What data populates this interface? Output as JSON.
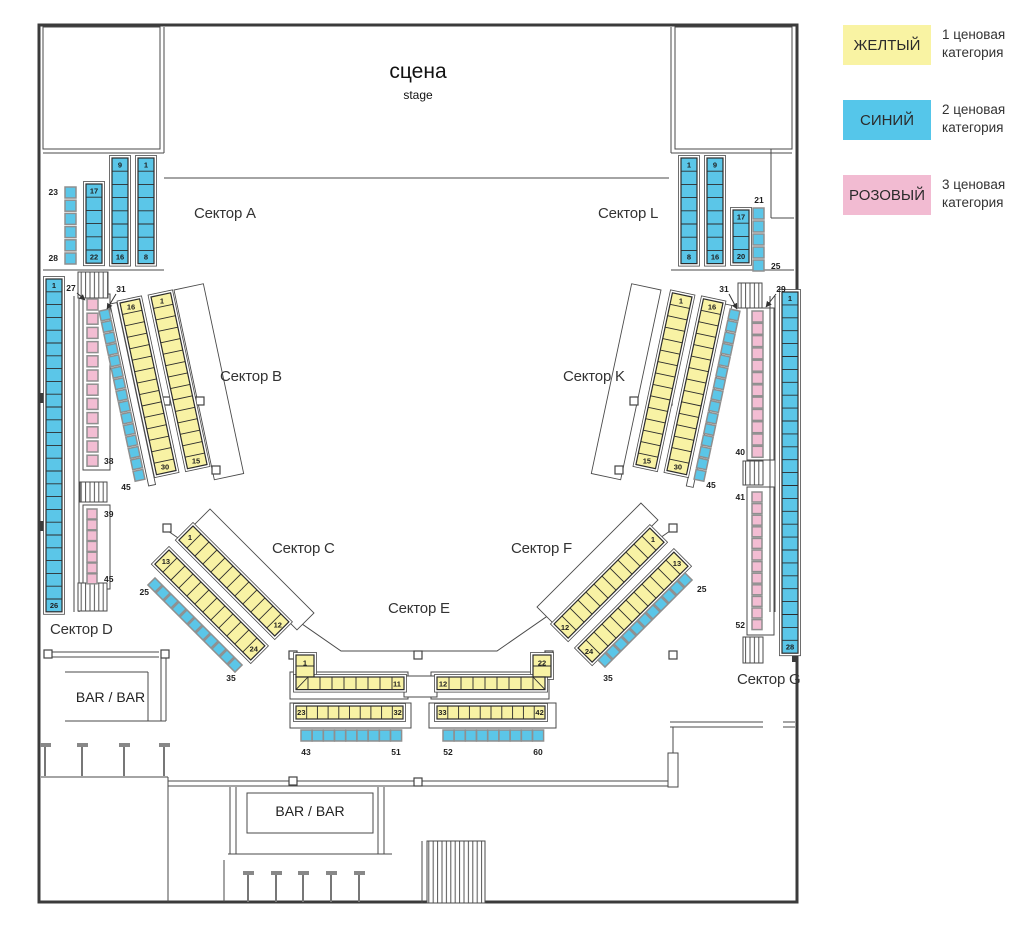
{
  "stage": {
    "title": "сцена",
    "subtitle": "stage"
  },
  "bars": {
    "left": "BAR / BAR",
    "bottom": "BAR / BAR"
  },
  "legend": [
    {
      "label": "ЖЕЛТЫЙ",
      "category": 1,
      "desc": "1 ценовая категория",
      "desc_lines": [
        "1 ценовая",
        "категория"
      ],
      "color": "#F9F3A3"
    },
    {
      "label": "СИНИЙ",
      "category": 2,
      "desc": "2 ценовая категория",
      "desc_lines": [
        "2 ценовая",
        "категория"
      ],
      "color": "#55C6EA"
    },
    {
      "label": "РОЗОВЫЙ",
      "category": 3,
      "desc": "3 ценовая категория",
      "desc_lines": [
        "3 ценовая",
        "категория"
      ],
      "color": "#F2BBD2"
    }
  ],
  "sectors": [
    {
      "id": "A",
      "label": "Сектор A"
    },
    {
      "id": "L",
      "label": "Сектор L"
    },
    {
      "id": "B",
      "label": "Сектор B"
    },
    {
      "id": "K",
      "label": "Сектор K"
    },
    {
      "id": "C",
      "label": "Сектор C"
    },
    {
      "id": "F",
      "label": "Сектор F"
    },
    {
      "id": "E",
      "label": "Сектор E"
    },
    {
      "id": "D",
      "label": "Сектор D"
    },
    {
      "id": "G",
      "label": "Сектор G"
    }
  ],
  "seat_colors": {
    "yellow": "#F8F2A4",
    "blue": "#5BC6E8",
    "pink": "#F3BDD3"
  },
  "seat_groups": [
    {
      "id": "a-strip-1-8",
      "sector": "A",
      "color": "blue",
      "category": 2,
      "first": 1,
      "last": 8,
      "count": 8,
      "label_start": "1",
      "label_end": "8"
    },
    {
      "id": "a-strip-9-16",
      "sector": "A",
      "color": "blue",
      "category": 2,
      "first": 9,
      "last": 16,
      "count": 8,
      "label_start": "9",
      "label_end": "16"
    },
    {
      "id": "a-strip-17-22",
      "sector": "A",
      "color": "blue",
      "category": 2,
      "first": 17,
      "last": 22,
      "count": 6,
      "label_start": "17",
      "label_end": "22"
    },
    {
      "id": "a-ind-23-28",
      "sector": "A",
      "color": "blue",
      "category": 2,
      "first": 23,
      "last": 28,
      "count": 6,
      "label_start": "23",
      "label_end": "28"
    },
    {
      "id": "l-strip-1-8",
      "sector": "L",
      "color": "blue",
      "category": 2,
      "first": 1,
      "last": 8,
      "count": 8,
      "label_start": "1",
      "label_end": "8"
    },
    {
      "id": "l-strip-9-16",
      "sector": "L",
      "color": "blue",
      "category": 2,
      "first": 9,
      "last": 16,
      "count": 8,
      "label_start": "9",
      "label_end": "16"
    },
    {
      "id": "l-strip-17-20",
      "sector": "L",
      "color": "blue",
      "category": 2,
      "first": 17,
      "last": 20,
      "count": 4,
      "label_start": "17",
      "label_end": "20"
    },
    {
      "id": "l-ind-21-25",
      "sector": "L",
      "color": "blue",
      "category": 2,
      "first": 21,
      "last": 25,
      "count": 5,
      "label_start": "21",
      "label_end": "25"
    },
    {
      "id": "b-strip-1-15",
      "sector": "B",
      "color": "yellow",
      "category": 1,
      "first": 1,
      "last": 15,
      "count": 15,
      "label_start": "1",
      "label_end": "15"
    },
    {
      "id": "b-strip-16-30",
      "sector": "B",
      "color": "yellow",
      "category": 1,
      "first": 16,
      "last": 30,
      "count": 15,
      "label_start": "16",
      "label_end": "30"
    },
    {
      "id": "b-ind-31-45",
      "sector": "B",
      "color": "blue",
      "category": 2,
      "first": 31,
      "last": 45,
      "count": 15,
      "label_end": "45"
    },
    {
      "id": "c-strip-1-12",
      "sector": "C",
      "color": "yellow",
      "category": 1,
      "first": 1,
      "last": 12,
      "count": 12,
      "label_start": "1",
      "label_end": "12"
    },
    {
      "id": "c-strip-13-24",
      "sector": "C",
      "color": "yellow",
      "category": 1,
      "first": 13,
      "last": 24,
      "count": 12,
      "label_start": "13",
      "label_end": "24"
    },
    {
      "id": "c-ind-25-35",
      "sector": "C",
      "color": "blue",
      "category": 2,
      "first": 25,
      "last": 35,
      "count": 11,
      "label_start": "25",
      "label_end": "35"
    },
    {
      "id": "e-l-1-11",
      "sector": "E",
      "color": "yellow",
      "category": 1,
      "first": 1,
      "last": 11,
      "count": 11,
      "label_start": "1",
      "label_end": "11"
    },
    {
      "id": "e-r-12-22",
      "sector": "E",
      "color": "yellow",
      "category": 1,
      "first": 12,
      "last": 22,
      "count": 11,
      "label_start": "12",
      "label_end": "22"
    },
    {
      "id": "e-l-23-32",
      "sector": "E",
      "color": "yellow",
      "category": 1,
      "first": 23,
      "last": 32,
      "count": 10,
      "label_start": "23",
      "label_end": "32"
    },
    {
      "id": "e-r-33-42",
      "sector": "E",
      "color": "yellow",
      "category": 1,
      "first": 33,
      "last": 42,
      "count": 10,
      "label_start": "33",
      "label_end": "42"
    },
    {
      "id": "e-l-43-51",
      "sector": "E",
      "color": "blue",
      "category": 2,
      "first": 43,
      "last": 51,
      "count": 9,
      "label_start": "43",
      "label_end": "51"
    },
    {
      "id": "e-r-52-60",
      "sector": "E",
      "color": "blue",
      "category": 2,
      "first": 52,
      "last": 60,
      "count": 9,
      "label_start": "52",
      "label_end": "60"
    },
    {
      "id": "f-strip-1-12",
      "sector": "F",
      "color": "yellow",
      "category": 1,
      "first": 1,
      "last": 12,
      "count": 12,
      "label_start": "12",
      "label_end": "1"
    },
    {
      "id": "f-strip-13-24",
      "sector": "F",
      "color": "yellow",
      "category": 1,
      "first": 13,
      "last": 24,
      "count": 12,
      "label_start": "24",
      "label_end": "13"
    },
    {
      "id": "f-ind-25-35",
      "sector": "F",
      "color": "blue",
      "category": 2,
      "first": 25,
      "last": 35,
      "count": 11,
      "label_start": "25",
      "label_end": "35"
    },
    {
      "id": "k-strip-1-15",
      "sector": "K",
      "color": "yellow",
      "category": 1,
      "first": 1,
      "last": 15,
      "count": 15,
      "label_start": "1",
      "label_end": "15"
    },
    {
      "id": "k-strip-16-30",
      "sector": "K",
      "color": "yellow",
      "category": 1,
      "first": 16,
      "last": 30,
      "count": 15,
      "label_start": "16",
      "label_end": "30"
    },
    {
      "id": "k-ind-31-45",
      "sector": "K",
      "color": "blue",
      "category": 2,
      "first": 31,
      "last": 45,
      "count": 15,
      "label_end": "45"
    },
    {
      "id": "d-strip-1-26",
      "sector": "D",
      "color": "blue",
      "category": 2,
      "first": 1,
      "last": 26,
      "count": 26,
      "label_start": "1",
      "label_end": "26"
    },
    {
      "id": "d-pink-27-38",
      "sector": "D",
      "color": "pink",
      "category": 3,
      "first": 27,
      "last": 38,
      "count": 12,
      "label_end": "38"
    },
    {
      "id": "d-pink-39-45",
      "sector": "D",
      "color": "pink",
      "category": 3,
      "first": 39,
      "last": 45,
      "count": 7,
      "label_start": "39",
      "label_end": "45"
    },
    {
      "id": "g-strip-1-28",
      "sector": "G",
      "color": "blue",
      "category": 2,
      "first": 1,
      "last": 28,
      "count": 28,
      "label_start": "1",
      "label_end": "28"
    },
    {
      "id": "g-pink-29-40",
      "sector": "G",
      "color": "pink",
      "category": 3,
      "first": 29,
      "last": 40,
      "count": 12,
      "label_end": "40"
    },
    {
      "id": "g-pink-41-52",
      "sector": "G",
      "color": "pink",
      "category": 3,
      "first": 41,
      "last": 52,
      "count": 12,
      "label_start": "41",
      "label_end": "52"
    }
  ],
  "callouts": [
    {
      "id": "d-27",
      "text": "27"
    },
    {
      "id": "b-31",
      "text": "31"
    },
    {
      "id": "k-31",
      "text": "31"
    },
    {
      "id": "g-29",
      "text": "29"
    }
  ]
}
